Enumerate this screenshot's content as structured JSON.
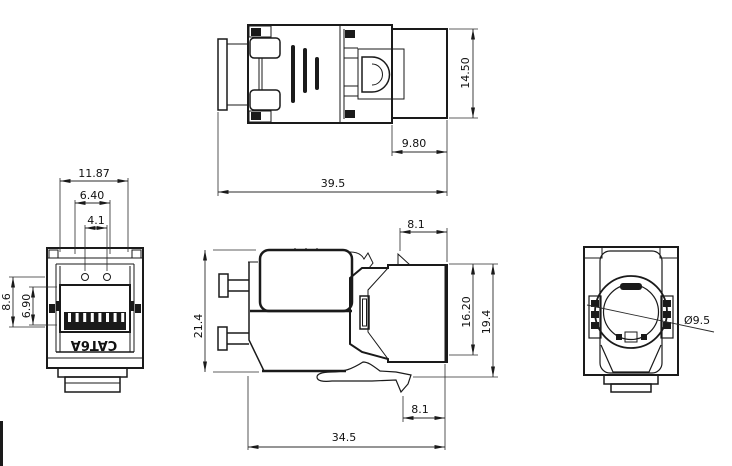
{
  "part_label": "CAT6A",
  "views": {
    "top": {
      "dims": {
        "height": "14.50",
        "rear_depth": "9.80",
        "overall_length": "39.5"
      }
    },
    "front": {
      "dims": {
        "outer_width": "11.87",
        "inner_width": "6.40",
        "tab_span": "4.1",
        "port_outer_height": "8.6",
        "port_inner_height": "6.90"
      }
    },
    "side": {
      "dims": {
        "overall_height": "21.4",
        "top_tab_depth": "8.1",
        "face_inner_height": "16.20",
        "face_outer_height": "19.4",
        "bottom_tab_depth": "8.1",
        "body_length": "34.5"
      }
    },
    "rear": {
      "dims": {
        "cable_entry_diameter": "Ø9.5"
      }
    }
  },
  "colors": {
    "line": "#1a1a1a",
    "background": "#ffffff"
  }
}
